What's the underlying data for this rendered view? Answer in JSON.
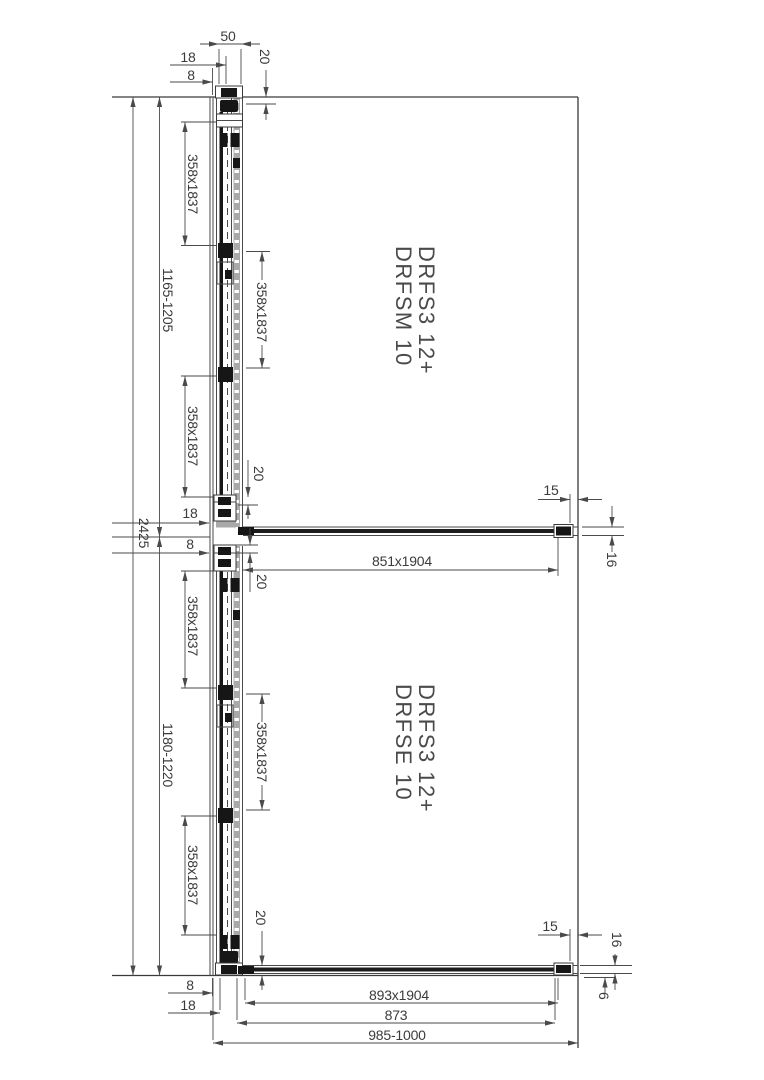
{
  "drawing": {
    "overall_height": "2425",
    "upper_unit": {
      "models": [
        "DRFS3 12+",
        "DRFSM 10"
      ],
      "height_range": "1165-1205",
      "rail_width": "50",
      "glass_to_wall": "18",
      "profile_offset": "8",
      "ceiling_inset": "20",
      "glass_panels": [
        "358x1837",
        "358x1837",
        "358x1837"
      ],
      "side_panel": "851x1904",
      "bottom_inset": "20",
      "wall_gap": "15",
      "panel_offset": "16"
    },
    "lower_unit": {
      "models": [
        "DRFS3 12+",
        "DRFSE 10"
      ],
      "height_range": "1180-1220",
      "top_inset": "20",
      "glass_to_wall": "18",
      "profile_offset": "8",
      "glass_panels": [
        "358x1837",
        "358x1837",
        "358x1837"
      ],
      "side_panel": "893x1904",
      "inner_width": "873",
      "entry_range": "985-1000",
      "bottom_inset": "20",
      "wall_gap": "15",
      "panel_offset": "16",
      "floor_gap": "6",
      "base_offset_8": "8",
      "base_offset_18": "18"
    }
  }
}
